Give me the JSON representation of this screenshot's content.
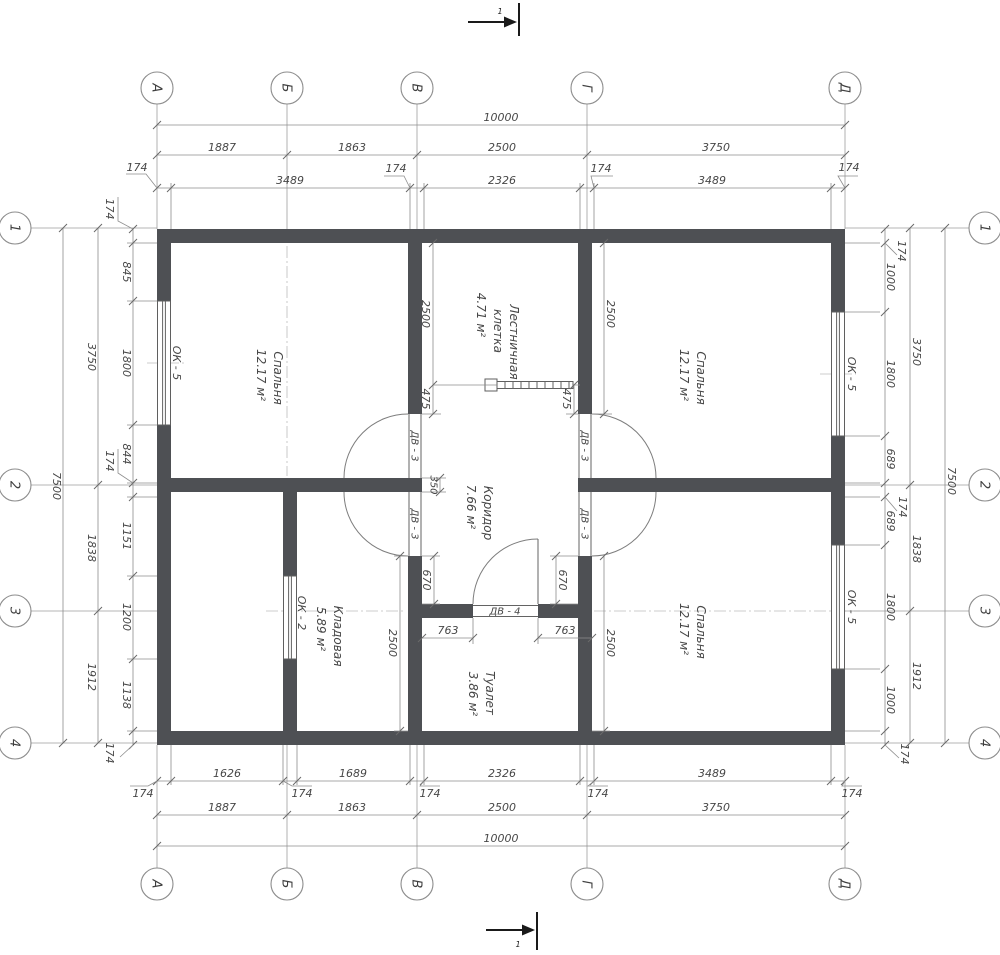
{
  "axes": {
    "cols": [
      "А",
      "Б",
      "В",
      "Г",
      "Д"
    ],
    "rows": [
      "1",
      "2",
      "3",
      "4"
    ]
  },
  "section": {
    "label": "1"
  },
  "off": "174",
  "dims_top": {
    "total": "10000",
    "chain": [
      "1887",
      "1863",
      "2500",
      "3750"
    ],
    "inner": [
      "3489",
      "2326",
      "3489"
    ]
  },
  "dims_bottom": {
    "total": "10000",
    "chain": [
      "1887",
      "1863",
      "2500",
      "3750"
    ],
    "inner": [
      "1626",
      "1689",
      "2326",
      "3489"
    ]
  },
  "dims_left": {
    "total": "7500",
    "chain": [
      "3750",
      "1838",
      "1912"
    ],
    "inner": [
      "845",
      "1800",
      "844",
      "1151",
      "1200",
      "1138"
    ]
  },
  "dims_right": {
    "total": "7500",
    "chain": [
      "3750",
      "1838",
      "1912"
    ],
    "inner": [
      "1000",
      "1800",
      "689",
      "689",
      "1800",
      "1000"
    ]
  },
  "dims_interior": {
    "d2500": "2500",
    "d475": "475",
    "d350": "350",
    "d670": "670",
    "d763": "763"
  },
  "rooms": {
    "bedroom_left": {
      "name": "Спальня",
      "area": "12.17 м²"
    },
    "bedroom_top_right": {
      "name": "Спальня",
      "area": "12.17 м²"
    },
    "bedroom_bottom_right": {
      "name": "Спальня",
      "area": "12.17 м²"
    },
    "staircase": {
      "name_line1": "Лестничная",
      "name_line2": "клетка",
      "area": "4.71 м²"
    },
    "corridor": {
      "name": "Коридор",
      "area": "7.66 м²"
    },
    "storage": {
      "name": "Кладовая",
      "area": "5.89 м²"
    },
    "toilet": {
      "name": "Туалет",
      "area": "3.86 м²"
    }
  },
  "windows": {
    "ok5": "ОК - 5",
    "ok2": "ОК - 2"
  },
  "doors": {
    "dv3": "ДВ - 3",
    "dv4": "ДВ - 4"
  }
}
